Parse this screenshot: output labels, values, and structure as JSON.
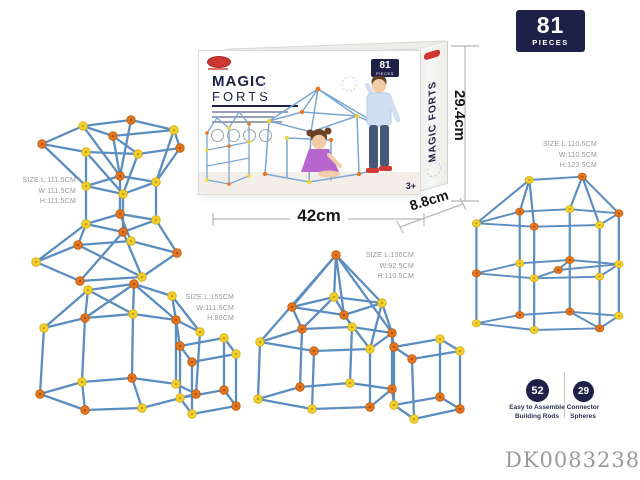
{
  "pieces_badge": {
    "number": "81",
    "label": "PIECES"
  },
  "box": {
    "brand_line1": "MAGIC",
    "brand_line2": "FORTS",
    "badge_number": "81",
    "badge_label": "PIECES",
    "age_label": "3+",
    "side_text": "MAGIC FORTS"
  },
  "dimensions": {
    "width": "42cm",
    "depth": "8.8cm",
    "height": "29.4cm"
  },
  "structures": [
    {
      "name": "hourglass fort",
      "l1": "SIZE L:111.5CM",
      "l2": "W:111.5CM",
      "l3": "H:111.5CM"
    },
    {
      "name": "tower fort",
      "l1": "SIZE L:110.5CM",
      "l2": "W:110.5CM",
      "l3": "H:123.5CM"
    },
    {
      "name": "dome fort",
      "l1": "SIZE L:155CM",
      "l2": "W:111.5CM",
      "l3": "H:80CM"
    },
    {
      "name": "pyramid fort",
      "l1": "SIZE L:136CM",
      "l2": "W:92.5CM",
      "l3": "H:110.5CM"
    }
  ],
  "counts": {
    "rods": {
      "number": "52",
      "line1": "Easy to Assemble",
      "line2": "Building Rods"
    },
    "spheres": {
      "number": "29",
      "line1": "Connector",
      "line2": "Spheres"
    }
  },
  "product_code": "DK00832385",
  "colors": {
    "navy": "#1d2147",
    "rod_blue": "#5b8dc0",
    "ball_orange": "#e8781f",
    "ball_yellow": "#f3d32f"
  }
}
